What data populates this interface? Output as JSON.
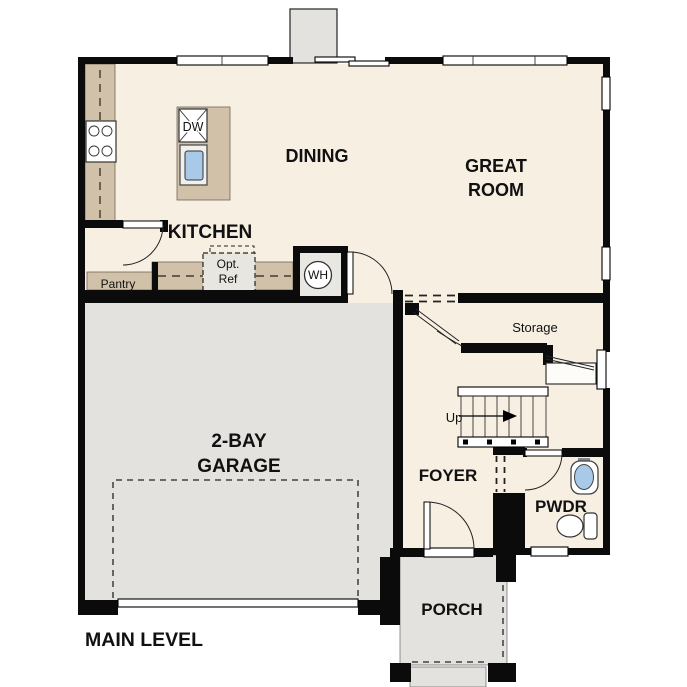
{
  "plan": {
    "title": "MAIN LEVEL",
    "rooms": {
      "kitchen": "KITCHEN",
      "dining": "DINING",
      "great_room": [
        "GREAT",
        "ROOM"
      ],
      "garage": [
        "2-BAY",
        "GARAGE"
      ],
      "foyer": "FOYER",
      "powder": "PWDR",
      "porch": "PORCH",
      "storage": "Storage",
      "pantry": "Pantry"
    },
    "annotations": {
      "stairs_up": "Up",
      "optional_fridge": [
        "Opt.",
        "Ref"
      ],
      "water_heater": "WH",
      "dishwasher": "DW"
    },
    "colors": {
      "wall": "#0b0b0b",
      "floor": "#f7efe2",
      "counter": "#d0c1a8",
      "slab": "#e3e2df",
      "fixture_blue": "#a9c9e8",
      "background": "#ffffff"
    }
  }
}
